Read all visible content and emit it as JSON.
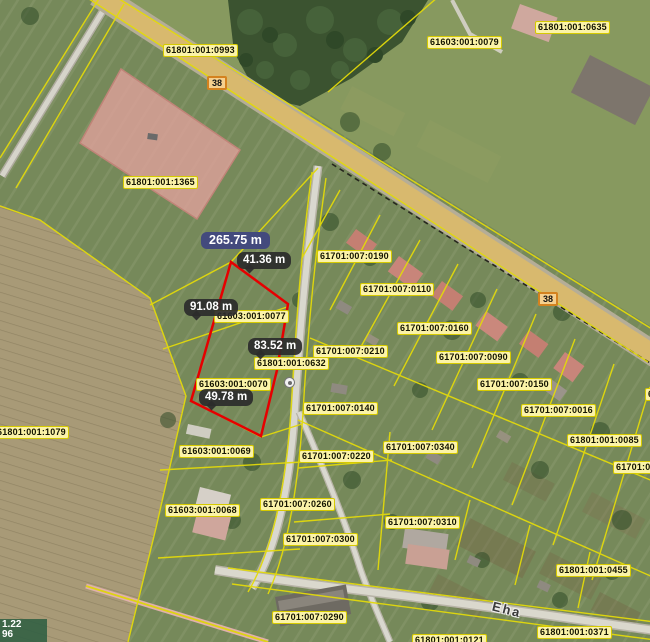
{
  "colors": {
    "parcel_line": "#e3da0a",
    "selection_red": "#e60000",
    "label_bg": "#fbf3a8",
    "label_border": "#d6ca00",
    "measure_total_bg": "#434a7d",
    "measure_segment_bg": "#2b2b2b",
    "road_badge_bg": "#f6d08e",
    "road_badge_border": "#d4821f",
    "coords_bg": "#2f5e42"
  },
  "map": {
    "street_name": "Eha",
    "road_badges": [
      {
        "text": "38",
        "x": 207,
        "y": 76
      },
      {
        "text": "38",
        "x": 538,
        "y": 292
      }
    ],
    "parcel_labels": [
      {
        "text": "61801:001:0993",
        "x": 163,
        "y": 44
      },
      {
        "text": "61603:001:0079",
        "x": 427,
        "y": 36
      },
      {
        "text": "61801:001:0635",
        "x": 535,
        "y": 21
      },
      {
        "text": "61801:001:1365",
        "x": 123,
        "y": 176
      },
      {
        "text": "61701:007:0190",
        "x": 317,
        "y": 250
      },
      {
        "text": "61701:007:0110",
        "x": 360,
        "y": 283
      },
      {
        "text": "61701:007:0160",
        "x": 397,
        "y": 322
      },
      {
        "text": "61701:007:0210",
        "x": 313,
        "y": 345
      },
      {
        "text": "61701:007:0090",
        "x": 436,
        "y": 351
      },
      {
        "text": "61701:007:0150",
        "x": 477,
        "y": 378
      },
      {
        "text": "61701:007:0016",
        "x": 521,
        "y": 404
      },
      {
        "text": "61801:001:0085",
        "x": 567,
        "y": 434
      },
      {
        "text": "61603:001:0077",
        "x": 214,
        "y": 310
      },
      {
        "text": "61801:001:0632",
        "x": 254,
        "y": 357
      },
      {
        "text": "61603:001:0070",
        "x": 196,
        "y": 378
      },
      {
        "text": "61701:007:0140",
        "x": 303,
        "y": 402
      },
      {
        "text": "61801:001:1079",
        "x": -6,
        "y": 426
      },
      {
        "text": "61701:007:0340",
        "x": 383,
        "y": 441
      },
      {
        "text": "61603:001:0069",
        "x": 179,
        "y": 445
      },
      {
        "text": "61701:007:0220",
        "x": 299,
        "y": 450
      },
      {
        "text": "61701:007:0260",
        "x": 260,
        "y": 498
      },
      {
        "text": "61603:001:0068",
        "x": 165,
        "y": 504
      },
      {
        "text": "61701:007:0310",
        "x": 385,
        "y": 516
      },
      {
        "text": "61701:007:0300",
        "x": 283,
        "y": 533
      },
      {
        "text": "61801:001:0455",
        "x": 556,
        "y": 564
      },
      {
        "text": "61701:007:0290",
        "x": 272,
        "y": 611
      },
      {
        "text": "61801:001:0371",
        "x": 537,
        "y": 626
      },
      {
        "text": "61801:001:0121",
        "x": 412,
        "y": 634
      },
      {
        "text": "61701:0",
        "x": 613,
        "y": 461
      },
      {
        "text": "6",
        "x": 645,
        "y": 388
      }
    ],
    "measurements": {
      "total": {
        "text": "265.75 m",
        "x": 201,
        "y": 232
      },
      "segments": [
        {
          "text": "41.36 m",
          "x": 237,
          "y": 252
        },
        {
          "text": "91.08 m",
          "x": 184,
          "y": 299
        },
        {
          "text": "83.52 m",
          "x": 248,
          "y": 338
        },
        {
          "text": "49.78 m",
          "x": 199,
          "y": 389
        }
      ]
    },
    "coordinates_readout": {
      "line1": "1.22",
      "line2": "96"
    }
  }
}
